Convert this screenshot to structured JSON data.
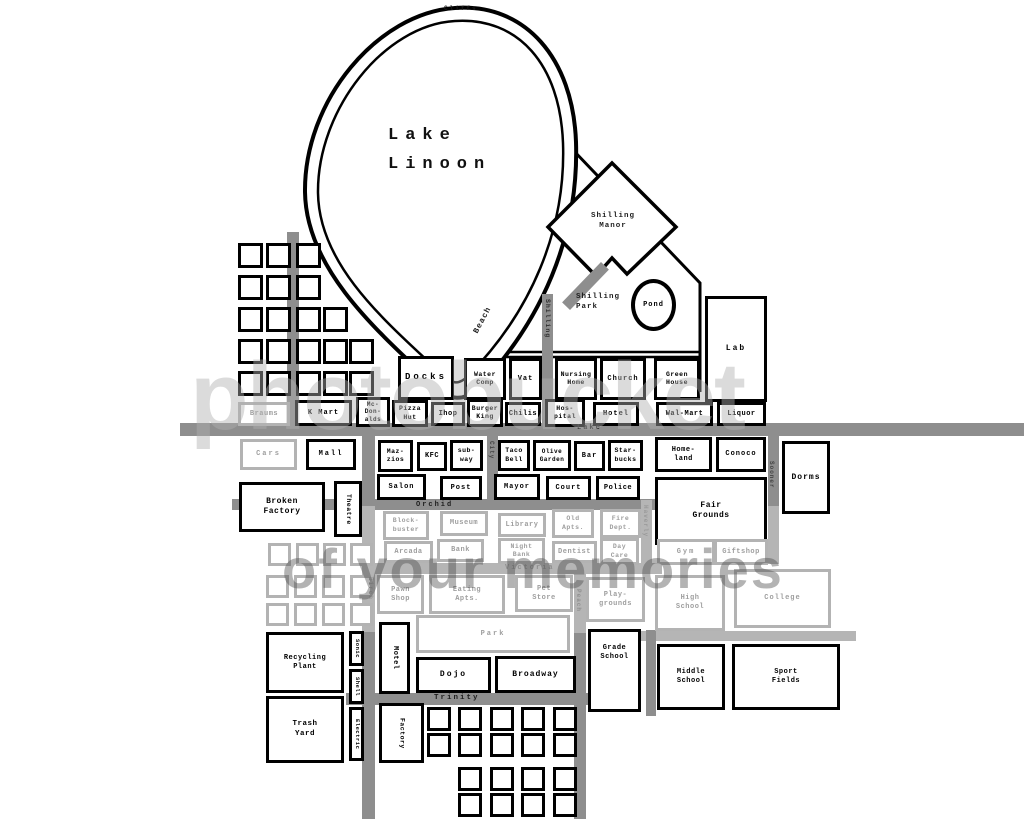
{
  "map_title": "Lake Linoon town map",
  "lake": {
    "name": "Lake\nLinoon",
    "cliffs_label": "Cliffs"
  },
  "pond": {
    "label": "Pond"
  },
  "watermark": {
    "line1": "photobucket",
    "line2": "of your memories"
  },
  "labels": [
    {
      "id": "cliffs",
      "text": "Cliffs",
      "x": 444,
      "y": 5,
      "fs": 6,
      "ls": 2
    },
    {
      "id": "lake-name",
      "text": "Lake\nLinoon",
      "x": 388,
      "y": 122,
      "fs": 17,
      "ls": 7,
      "lh": 1.7,
      "color": "#111111"
    },
    {
      "id": "shilling-manor",
      "text": "Shilling\nManor",
      "x": 578,
      "y": 212,
      "fs": 7.5,
      "ls": 1,
      "w": 70,
      "align": "center"
    },
    {
      "id": "shilling-park",
      "text": "Shilling\nPark",
      "x": 576,
      "y": 293,
      "fs": 7.5,
      "ls": 1
    },
    {
      "id": "beach-street",
      "text": "Beach",
      "x": 472,
      "y": 331,
      "fs": 8,
      "ls": 1,
      "rot": -62
    },
    {
      "id": "shilling-street",
      "text": "Shilling",
      "x": 551,
      "y": 299,
      "fs": 6.5,
      "ls": 1,
      "rot": 90,
      "color": "#2e2e2e"
    },
    {
      "id": "lake-street",
      "text": "Lake",
      "x": 577,
      "y": 424,
      "fs": 7,
      "ls": 2
    },
    {
      "id": "orchid-street",
      "text": "Orchid",
      "x": 416,
      "y": 501,
      "fs": 7,
      "ls": 2
    },
    {
      "id": "victoria-street",
      "text": "Victoria",
      "x": 505,
      "y": 564,
      "fs": 7,
      "ls": 2,
      "color": "#8f8f8f"
    },
    {
      "id": "trinity-street",
      "text": "Trinity",
      "x": 434,
      "y": 694,
      "fs": 7.5,
      "ls": 2
    },
    {
      "id": "city-street",
      "text": "City",
      "x": 495,
      "y": 441,
      "fs": 6,
      "ls": 1,
      "rot": 90,
      "color": "#444444"
    },
    {
      "id": "haverly-street",
      "text": "Haverly",
      "x": 649,
      "y": 505,
      "fs": 6,
      "ls": 1,
      "rot": 90,
      "color": "#999999"
    },
    {
      "id": "sooner-street",
      "text": "Sooner",
      "x": 775,
      "y": 461,
      "fs": 6,
      "ls": 1,
      "rot": 90,
      "color": "#444444"
    },
    {
      "id": "peach-street",
      "text": "Peach",
      "x": 582,
      "y": 589,
      "fs": 6,
      "ls": 1,
      "rot": 90,
      "color": "#8f8f8f"
    },
    {
      "id": "birch-street",
      "text": "Birch",
      "x": 374,
      "y": 577,
      "fs": 6,
      "ls": 1,
      "rot": 90,
      "color": "#999999"
    }
  ],
  "roads": [
    {
      "id": "lake-road",
      "x": 180,
      "y": 423,
      "w": 844,
      "h": 13
    },
    {
      "id": "orchid-road",
      "x": 232,
      "y": 499,
      "w": 426,
      "h": 11
    },
    {
      "id": "victoria-road",
      "x": 366,
      "y": 563,
      "w": 296,
      "h": 11,
      "c": "#b5b5b5"
    },
    {
      "id": "trinity-road",
      "x": 346,
      "y": 693,
      "w": 242,
      "h": 12
    },
    {
      "id": "school-road",
      "x": 640,
      "y": 631,
      "w": 216,
      "h": 10,
      "c": "#b5b5b5"
    },
    {
      "id": "birch-road-n",
      "x": 362,
      "y": 436,
      "w": 13,
      "h": 70
    },
    {
      "id": "birch-road-m",
      "x": 362,
      "y": 506,
      "w": 13,
      "h": 126,
      "c": "#b5b5b5"
    },
    {
      "id": "birch-road-s",
      "x": 362,
      "y": 632,
      "w": 13,
      "h": 187
    },
    {
      "id": "left-road",
      "x": 287,
      "y": 232,
      "w": 12,
      "h": 192
    },
    {
      "id": "shilling-road",
      "x": 542,
      "y": 294,
      "w": 11,
      "h": 130
    },
    {
      "id": "shilling-road-diag",
      "x": 580,
      "y": 258,
      "w": 11,
      "h": 56,
      "rot": 44
    },
    {
      "id": "city-road",
      "x": 487,
      "y": 436,
      "w": 11,
      "h": 64
    },
    {
      "id": "haverly-road",
      "x": 641,
      "y": 500,
      "w": 11,
      "h": 64,
      "c": "#b5b5b5"
    },
    {
      "id": "sooner-road",
      "x": 768,
      "y": 436,
      "w": 11,
      "h": 70
    },
    {
      "id": "sooner-road-s",
      "x": 768,
      "y": 506,
      "w": 11,
      "h": 58,
      "c": "#b5b5b5"
    },
    {
      "id": "peach-road-n",
      "x": 574,
      "y": 563,
      "w": 12,
      "h": 70,
      "c": "#b5b5b5"
    },
    {
      "id": "peach-road-s",
      "x": 574,
      "y": 633,
      "w": 12,
      "h": 186
    },
    {
      "id": "midschool-road",
      "x": 646,
      "y": 630,
      "w": 10,
      "h": 86
    }
  ],
  "buildings": [
    {
      "id": "docks",
      "label": "Docks",
      "x": 398,
      "y": 356,
      "w": 56,
      "h": 44,
      "fs": 9,
      "ls": 3
    },
    {
      "id": "water-comp",
      "label": "Water\nComp",
      "x": 464,
      "y": 358,
      "w": 42,
      "h": 42,
      "fs": 6.5
    },
    {
      "id": "vat",
      "label": "Vat",
      "x": 509,
      "y": 358,
      "w": 33,
      "h": 42,
      "fs": 7,
      "ls": 1
    },
    {
      "id": "nursing-home",
      "label": "Nursing\nHome",
      "x": 555,
      "y": 358,
      "w": 42,
      "h": 42,
      "fs": 6.5
    },
    {
      "id": "church",
      "label": "Church",
      "x": 600,
      "y": 358,
      "w": 46,
      "h": 42,
      "fs": 7,
      "ls": 1
    },
    {
      "id": "green-house",
      "label": "Green\nHouse",
      "x": 654,
      "y": 358,
      "w": 46,
      "h": 42,
      "fs": 6.5
    },
    {
      "id": "lab",
      "label": "Lab",
      "x": 705,
      "y": 296,
      "w": 62,
      "h": 106,
      "fs": 8,
      "ls": 2
    },
    {
      "id": "braums",
      "label": "Braums",
      "x": 238,
      "y": 402,
      "w": 52,
      "h": 24,
      "fs": 7,
      "faded": true
    },
    {
      "id": "k-mart",
      "label": "K Mart",
      "x": 295,
      "y": 400,
      "w": 57,
      "h": 26,
      "fs": 7,
      "ls": 1
    },
    {
      "id": "mcdonalds",
      "label": "Mc-\nDon-\nalds",
      "x": 356,
      "y": 397,
      "w": 34,
      "h": 30,
      "fs": 6
    },
    {
      "id": "pizza-hut",
      "label": "Pizza\nHut",
      "x": 392,
      "y": 400,
      "w": 36,
      "h": 27,
      "fs": 6.5
    },
    {
      "id": "ihop",
      "label": "Ihop",
      "x": 431,
      "y": 402,
      "w": 34,
      "h": 24,
      "fs": 7
    },
    {
      "id": "burger-king",
      "label": "Burger\nKing",
      "x": 467,
      "y": 399,
      "w": 36,
      "h": 28,
      "fs": 6.5
    },
    {
      "id": "chilis",
      "label": "Chilis",
      "x": 505,
      "y": 402,
      "w": 36,
      "h": 24,
      "fs": 7
    },
    {
      "id": "hospital",
      "label": "Hos-\npital",
      "x": 545,
      "y": 399,
      "w": 40,
      "h": 28,
      "fs": 6.5
    },
    {
      "id": "hotel",
      "label": "Hotel",
      "x": 593,
      "y": 402,
      "w": 46,
      "h": 24,
      "fs": 7,
      "ls": 1
    },
    {
      "id": "wal-mart",
      "label": "Wal-Mart",
      "x": 656,
      "y": 402,
      "w": 57,
      "h": 24,
      "fs": 7
    },
    {
      "id": "liquor",
      "label": "Liquor",
      "x": 717,
      "y": 402,
      "w": 49,
      "h": 24,
      "fs": 7
    },
    {
      "id": "cars",
      "label": "Cars",
      "x": 240,
      "y": 439,
      "w": 57,
      "h": 31,
      "fs": 7,
      "ls": 2,
      "faded": true
    },
    {
      "id": "mall",
      "label": "Mall",
      "x": 306,
      "y": 439,
      "w": 50,
      "h": 31,
      "fs": 7,
      "ls": 2
    },
    {
      "id": "mazzios",
      "label": "Maz-\nzios",
      "x": 378,
      "y": 440,
      "w": 35,
      "h": 32,
      "fs": 6.5
    },
    {
      "id": "kfc",
      "label": "KFC",
      "x": 417,
      "y": 442,
      "w": 30,
      "h": 29,
      "fs": 7
    },
    {
      "id": "subway",
      "label": "sub-\nway",
      "x": 450,
      "y": 440,
      "w": 33,
      "h": 31,
      "fs": 6.5
    },
    {
      "id": "taco-bell",
      "label": "Taco\nBell",
      "x": 498,
      "y": 440,
      "w": 32,
      "h": 31,
      "fs": 6.5
    },
    {
      "id": "olive-garden",
      "label": "Olive\nGarden",
      "x": 533,
      "y": 440,
      "w": 38,
      "h": 31,
      "fs": 6
    },
    {
      "id": "bar",
      "label": "Bar",
      "x": 574,
      "y": 441,
      "w": 31,
      "h": 30,
      "fs": 7,
      "ls": 1
    },
    {
      "id": "starbucks",
      "label": "Star-\nbucks",
      "x": 608,
      "y": 440,
      "w": 35,
      "h": 31,
      "fs": 6.5
    },
    {
      "id": "homeland",
      "label": "Home-\nland",
      "x": 655,
      "y": 437,
      "w": 57,
      "h": 35,
      "fs": 7
    },
    {
      "id": "conoco",
      "label": "Conoco",
      "x": 716,
      "y": 437,
      "w": 50,
      "h": 35,
      "fs": 7,
      "ls": 1
    },
    {
      "id": "dorms",
      "label": "Dorms",
      "x": 782,
      "y": 441,
      "w": 48,
      "h": 73,
      "fs": 8,
      "ls": 1
    },
    {
      "id": "salon",
      "label": "Salon",
      "x": 377,
      "y": 474,
      "w": 49,
      "h": 26,
      "fs": 7,
      "ls": 1
    },
    {
      "id": "post",
      "label": "Post",
      "x": 440,
      "y": 476,
      "w": 42,
      "h": 24,
      "fs": 7,
      "ls": 1
    },
    {
      "id": "mayor",
      "label": "Mayor",
      "x": 494,
      "y": 474,
      "w": 46,
      "h": 26,
      "fs": 7,
      "ls": 1
    },
    {
      "id": "court",
      "label": "Court",
      "x": 546,
      "y": 476,
      "w": 45,
      "h": 24,
      "fs": 7,
      "ls": 1
    },
    {
      "id": "police",
      "label": "Police",
      "x": 596,
      "y": 476,
      "w": 44,
      "h": 24,
      "fs": 7
    },
    {
      "id": "fair-grounds",
      "label": "Fair\nGrounds",
      "x": 655,
      "y": 477,
      "w": 112,
      "h": 68,
      "fs": 8
    },
    {
      "id": "theatre",
      "label": "Theatre",
      "x": 334,
      "y": 481,
      "w": 28,
      "h": 56,
      "fs": 6.5,
      "vertical": true
    },
    {
      "id": "broken-factory",
      "label": "Broken\nFactory",
      "x": 239,
      "y": 482,
      "w": 86,
      "h": 50,
      "fs": 8
    },
    {
      "id": "blockbuster",
      "label": "Block-\nbuster",
      "x": 383,
      "y": 511,
      "w": 46,
      "h": 29,
      "fs": 6.5,
      "faded": true
    },
    {
      "id": "museum",
      "label": "Museum",
      "x": 440,
      "y": 511,
      "w": 48,
      "h": 25,
      "fs": 7,
      "faded": true
    },
    {
      "id": "library",
      "label": "Library",
      "x": 498,
      "y": 513,
      "w": 48,
      "h": 24,
      "fs": 7,
      "faded": true
    },
    {
      "id": "old-apts",
      "label": "Old\nApts.",
      "x": 552,
      "y": 509,
      "w": 42,
      "h": 29,
      "fs": 6.5,
      "faded": true
    },
    {
      "id": "fire-dept",
      "label": "Fire\nDept.",
      "x": 600,
      "y": 509,
      "w": 41,
      "h": 29,
      "fs": 6.5,
      "faded": true
    },
    {
      "id": "arcada",
      "label": "Arcada",
      "x": 384,
      "y": 541,
      "w": 49,
      "h": 22,
      "fs": 7,
      "faded": true
    },
    {
      "id": "bank",
      "label": "Bank",
      "x": 437,
      "y": 539,
      "w": 47,
      "h": 23,
      "fs": 7,
      "faded": true
    },
    {
      "id": "night-bank",
      "label": "Night\nBank",
      "x": 498,
      "y": 538,
      "w": 47,
      "h": 26,
      "fs": 6.5,
      "faded": true
    },
    {
      "id": "dentist",
      "label": "Dentist",
      "x": 552,
      "y": 541,
      "w": 45,
      "h": 22,
      "fs": 7,
      "faded": true
    },
    {
      "id": "day-care",
      "label": "Day\nCare",
      "x": 600,
      "y": 538,
      "w": 39,
      "h": 27,
      "fs": 6.5,
      "faded": true
    },
    {
      "id": "gym",
      "label": "Gym",
      "x": 657,
      "y": 539,
      "w": 58,
      "h": 26,
      "fs": 7,
      "ls": 2,
      "faded": true
    },
    {
      "id": "giftshop",
      "label": "Giftshop",
      "x": 714,
      "y": 539,
      "w": 54,
      "h": 26,
      "fs": 7,
      "faded": true
    },
    {
      "id": "pawn-shop",
      "label": "Pawn\nShop",
      "x": 377,
      "y": 575,
      "w": 47,
      "h": 39,
      "fs": 7,
      "faded": true
    },
    {
      "id": "eating-apts",
      "label": "Eating\nApts.",
      "x": 429,
      "y": 575,
      "w": 76,
      "h": 39,
      "fs": 7,
      "faded": true
    },
    {
      "id": "pet-store",
      "label": "Pet\nStore",
      "x": 515,
      "y": 575,
      "w": 58,
      "h": 37,
      "fs": 7,
      "faded": true
    },
    {
      "id": "playgrounds",
      "label": "Play-\ngrounds",
      "x": 586,
      "y": 577,
      "w": 59,
      "h": 45,
      "fs": 7,
      "faded": true
    },
    {
      "id": "high-school",
      "label": "High\nSchool",
      "x": 655,
      "y": 575,
      "w": 70,
      "h": 56,
      "fs": 7,
      "faded": true
    },
    {
      "id": "college",
      "label": "College",
      "x": 734,
      "y": 569,
      "w": 97,
      "h": 59,
      "fs": 7,
      "ls": 1,
      "faded": true
    },
    {
      "id": "park",
      "label": "Park",
      "x": 416,
      "y": 615,
      "w": 154,
      "h": 38,
      "fs": 7,
      "ls": 2,
      "faded": true
    },
    {
      "id": "motel",
      "label": "Motel",
      "x": 379,
      "y": 622,
      "w": 31,
      "h": 72,
      "fs": 7,
      "vertical": true
    },
    {
      "id": "dojo",
      "label": "Dojo",
      "x": 416,
      "y": 657,
      "w": 75,
      "h": 36,
      "fs": 8,
      "ls": 2
    },
    {
      "id": "broadway",
      "label": "Broadway",
      "x": 495,
      "y": 656,
      "w": 81,
      "h": 37,
      "fs": 8,
      "ls": 1
    },
    {
      "id": "grade-school",
      "label": "Grade\nSchool",
      "x": 588,
      "y": 629,
      "w": 53,
      "h": 83,
      "fs": 7,
      "va": "top"
    },
    {
      "id": "middle-school",
      "label": "Middle\nSchool",
      "x": 657,
      "y": 644,
      "w": 68,
      "h": 66,
      "fs": 7
    },
    {
      "id": "sport-fields",
      "label": "Sport\nFields",
      "x": 732,
      "y": 644,
      "w": 108,
      "h": 66,
      "fs": 7
    },
    {
      "id": "recycling-plant",
      "label": "Recycling\nPlant",
      "x": 266,
      "y": 632,
      "w": 78,
      "h": 61,
      "fs": 7
    },
    {
      "id": "trash-yard",
      "label": "Trash\nYard",
      "x": 266,
      "y": 696,
      "w": 78,
      "h": 67,
      "fs": 7.5
    },
    {
      "id": "sonic",
      "label": "Sonic",
      "x": 349,
      "y": 631,
      "w": 15,
      "h": 35,
      "fs": 5.5,
      "vertical": true
    },
    {
      "id": "shell",
      "label": "Shell",
      "x": 349,
      "y": 669,
      "w": 15,
      "h": 35,
      "fs": 5.5,
      "vertical": true
    },
    {
      "id": "electric",
      "label": "Electric",
      "x": 349,
      "y": 707,
      "w": 15,
      "h": 54,
      "fs": 5.5,
      "vertical": true
    },
    {
      "id": "factory",
      "label": "Factory",
      "x": 379,
      "y": 703,
      "w": 45,
      "h": 60,
      "fs": 6.5,
      "vertical": true
    }
  ],
  "housing": [
    {
      "id": "north-houses",
      "color": "black",
      "s": 25,
      "pts": [
        [
          238,
          243
        ],
        [
          266,
          243
        ],
        [
          296,
          243
        ],
        [
          238,
          275
        ],
        [
          266,
          275
        ],
        [
          296,
          275
        ],
        [
          238,
          307
        ],
        [
          266,
          307
        ],
        [
          296,
          307
        ],
        [
          323,
          307
        ],
        [
          238,
          339
        ],
        [
          266,
          339
        ],
        [
          296,
          339
        ],
        [
          323,
          339
        ],
        [
          349,
          339
        ],
        [
          238,
          371
        ],
        [
          266,
          371
        ],
        [
          296,
          371
        ],
        [
          323,
          371
        ],
        [
          349,
          371
        ]
      ]
    },
    {
      "id": "west-houses",
      "color": "gray",
      "s": 23,
      "pts": [
        [
          268,
          543
        ],
        [
          296,
          543
        ],
        [
          323,
          543
        ],
        [
          350,
          543
        ],
        [
          266,
          575
        ],
        [
          294,
          575
        ],
        [
          322,
          575
        ],
        [
          350,
          575
        ],
        [
          266,
          603
        ],
        [
          294,
          603
        ],
        [
          322,
          603
        ],
        [
          350,
          603
        ]
      ]
    },
    {
      "id": "south-houses",
      "color": "black",
      "s": 24,
      "pts": [
        [
          427,
          707
        ],
        [
          458,
          707
        ],
        [
          490,
          707
        ],
        [
          521,
          707
        ],
        [
          553,
          707
        ],
        [
          427,
          733
        ],
        [
          458,
          733
        ],
        [
          490,
          733
        ],
        [
          521,
          733
        ],
        [
          553,
          733
        ],
        [
          458,
          767
        ],
        [
          490,
          767
        ],
        [
          521,
          767
        ],
        [
          553,
          767
        ],
        [
          458,
          793
        ],
        [
          490,
          793
        ],
        [
          521,
          793
        ],
        [
          553,
          793
        ]
      ]
    }
  ]
}
